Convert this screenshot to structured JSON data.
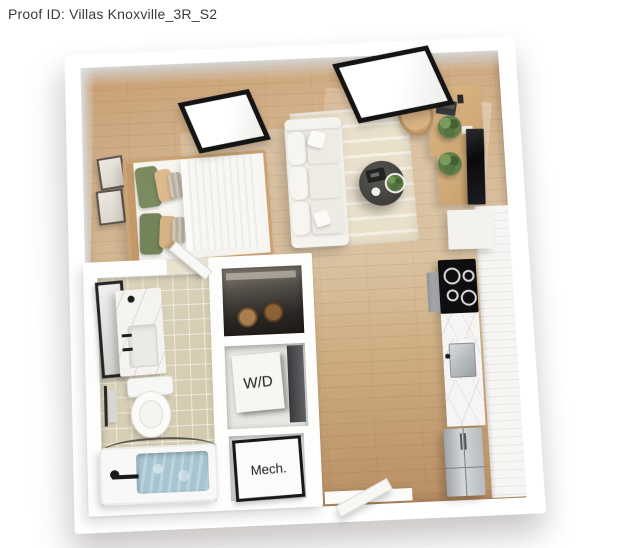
{
  "header": {
    "proof_id": "Proof ID: Villas Knoxville_3R_S2"
  },
  "floorplan": {
    "labels": {
      "washer_dryer": "W/D",
      "mechanical": "Mech."
    },
    "colors": {
      "wall": "#ffffff",
      "wood_floor": "#cfa87e",
      "bathroom_tile": "#d6cdb3",
      "rug": "#e9e0cc",
      "sofa": "#f1efe9",
      "coffee_table": "#403e3b",
      "pillow_green": "#7b8a5f",
      "pillow_tan": "#dcba8e",
      "desk_wood": "#d2ae7e",
      "window_frame": "#141414",
      "tv": "#0a0a0c",
      "cooktop": "#0e0e10",
      "stainless": "#b7bbbe",
      "counter_marble": "#f6f5f3",
      "tub_water": "#a7c5d1",
      "plant_green": "#5f7e48"
    }
  }
}
